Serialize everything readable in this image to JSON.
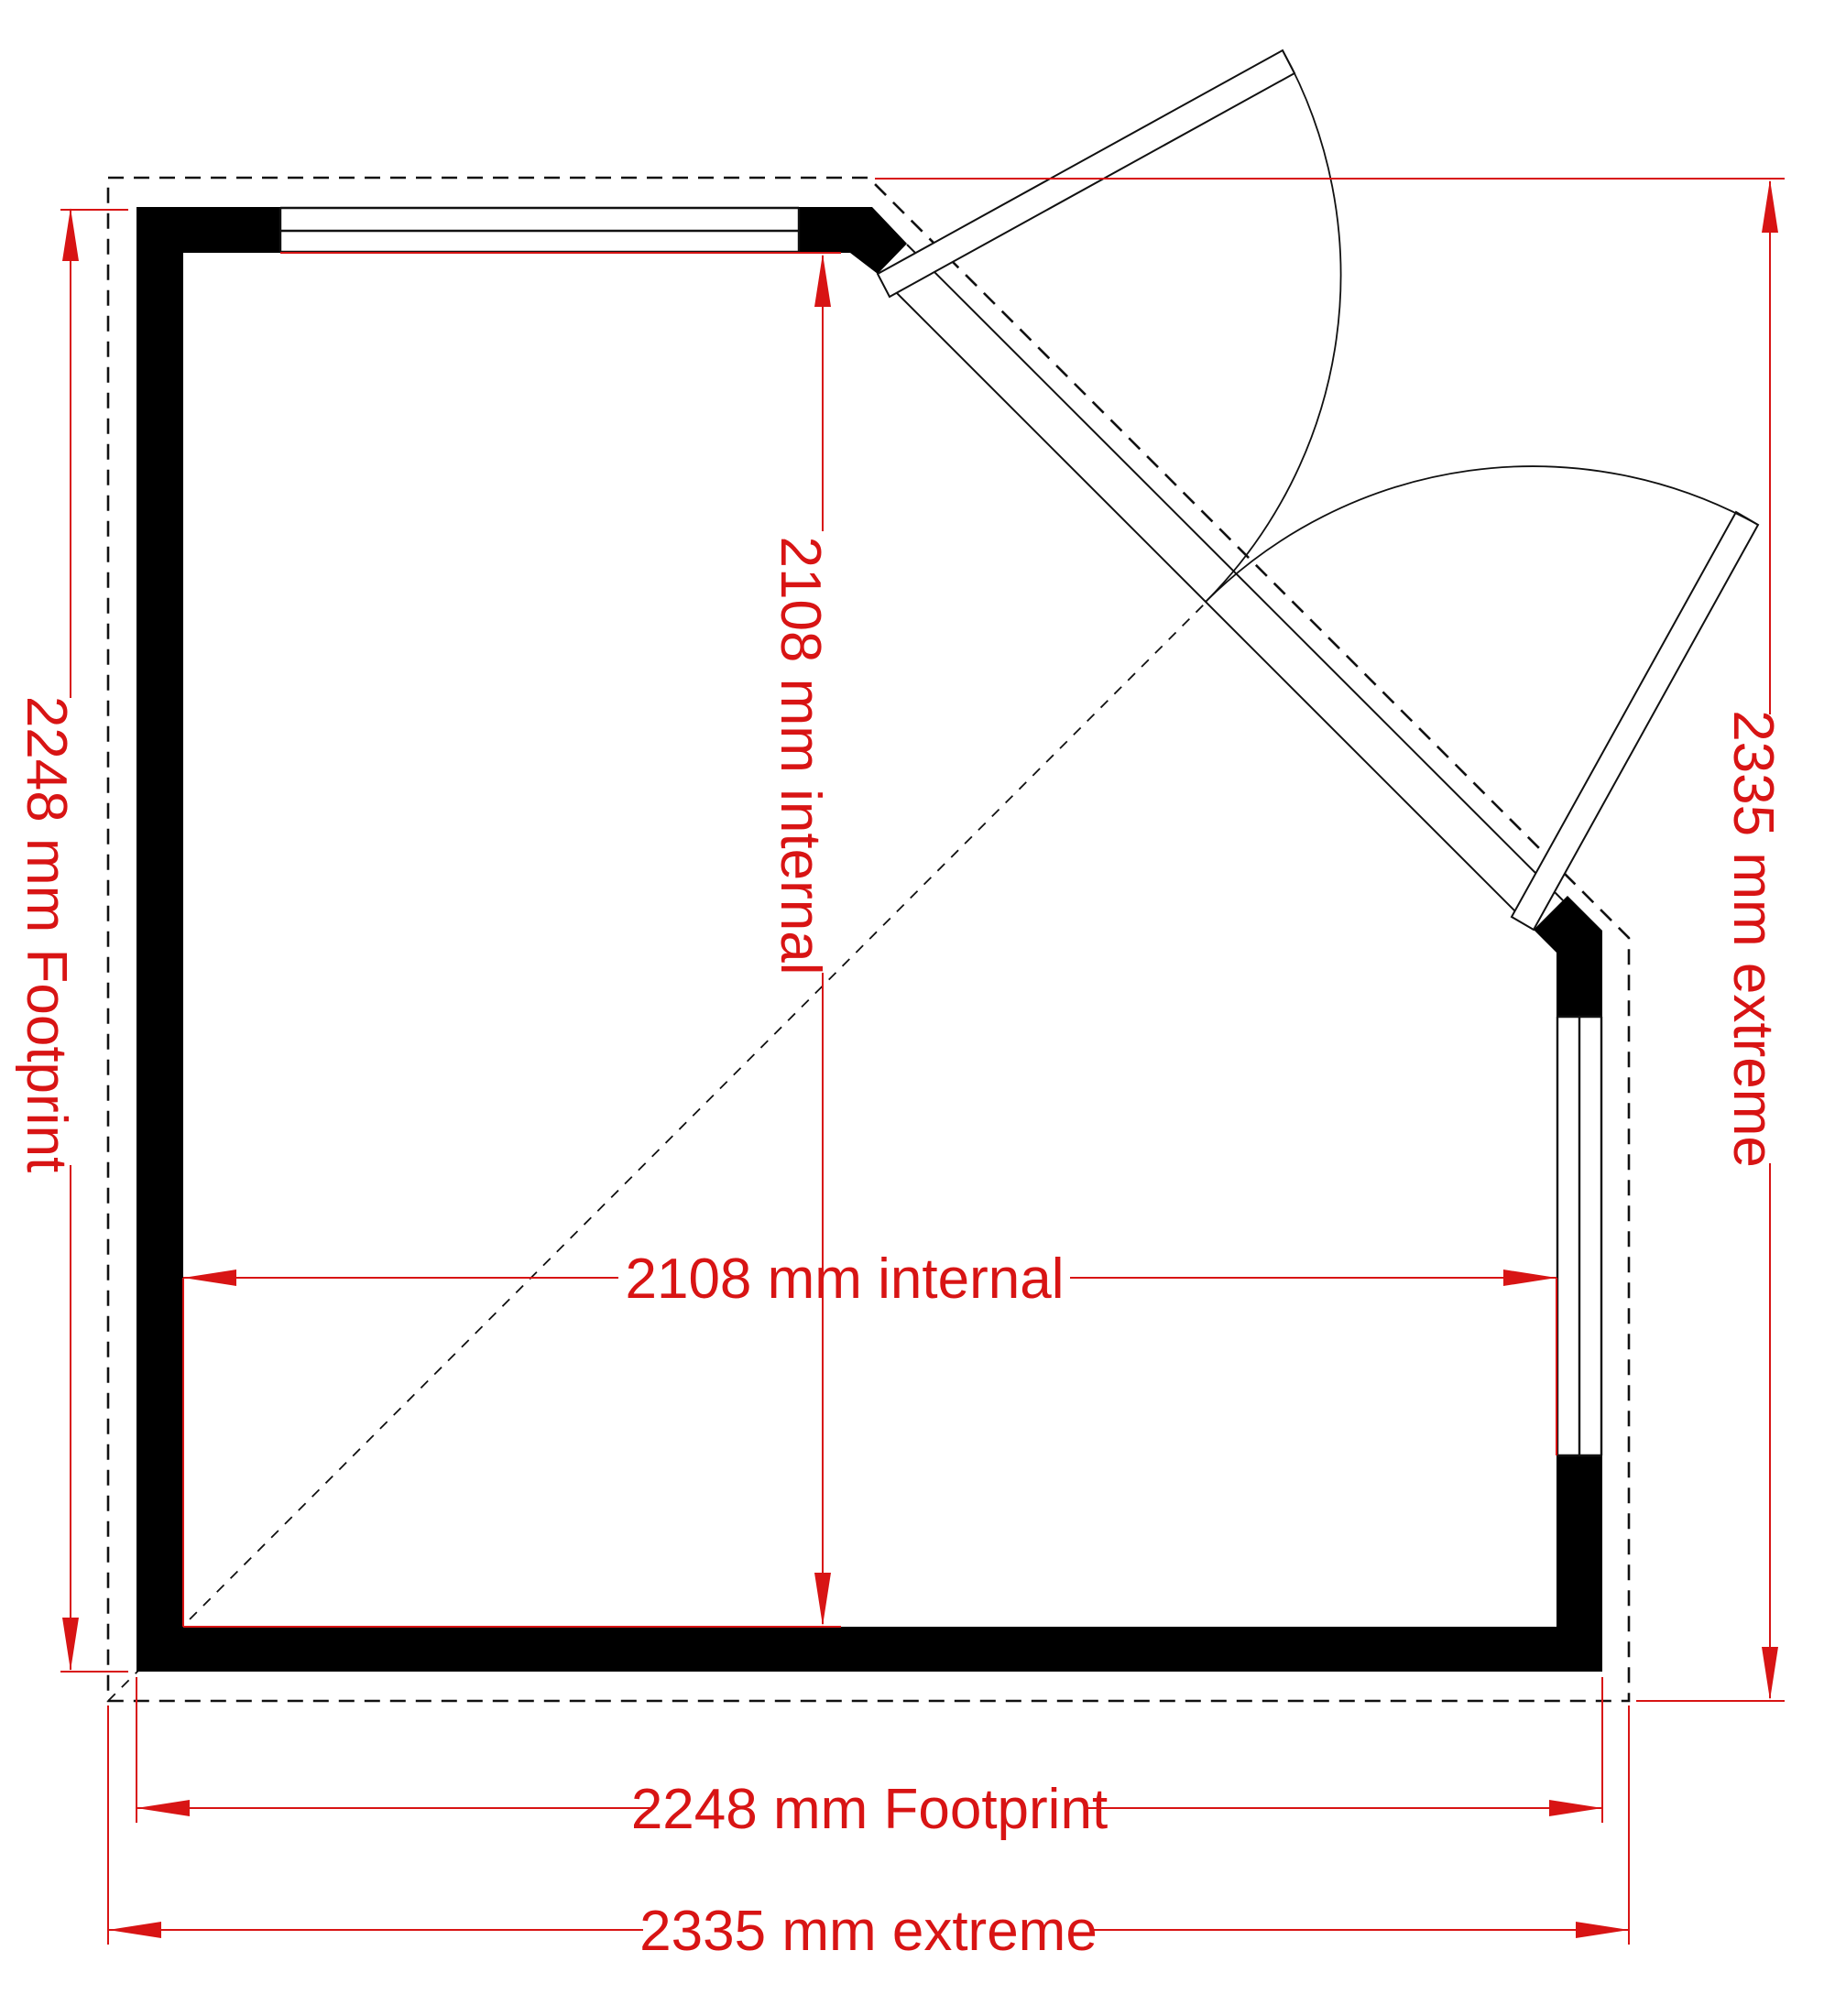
{
  "plan": {
    "type": "floor-plan",
    "footprint_mm": 2248,
    "extreme_mm": 2335,
    "internal_mm": 2108
  },
  "colors": {
    "dimension_red": "#d81414",
    "wall_black": "#000000",
    "line_black": "#111111",
    "background": "#ffffff"
  },
  "dimensions": {
    "left_footprint": {
      "label": "2248 mm Footprint"
    },
    "right_extreme": {
      "label": "2335 mm extreme"
    },
    "vertical_internal": {
      "label": "2108 mm internal"
    },
    "horizontal_internal": {
      "label": "2108 mm internal"
    },
    "bottom_footprint": {
      "label": "2248 mm Footprint"
    },
    "bottom_extreme": {
      "label": "2335 mm extreme"
    }
  }
}
